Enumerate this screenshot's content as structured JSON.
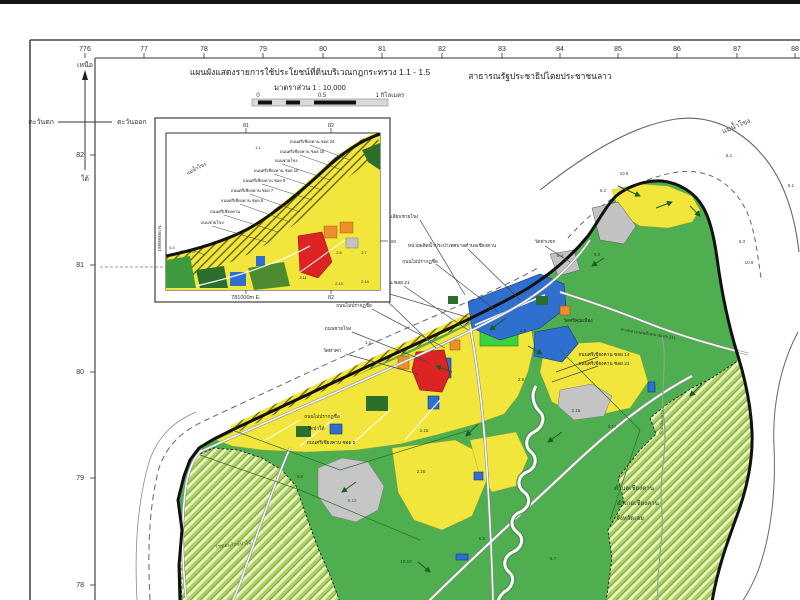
{
  "header": {
    "title": "แผนผังแสดงรายการใช้ประโยชน์ที่ดินบริเวณกฎกระทรวง 1.1 - 1.5",
    "scale_label": "มาตราส่วน 1 : 10,000",
    "scalebar": [
      "0",
      "0.5",
      "1 กิโลเมตร"
    ],
    "country": "สาธารณรัฐประชาธิปไตยประชาชนลาว"
  },
  "compass": {
    "north": "เหนือ",
    "south": "ใต้",
    "west": "ตะวันตก",
    "east": "ตะวันออก"
  },
  "grid": {
    "top": [
      {
        "t": "776",
        "x": 85
      },
      {
        "t": "77",
        "x": 144
      },
      {
        "t": "78",
        "x": 204
      },
      {
        "t": "79",
        "x": 263
      },
      {
        "t": "80",
        "x": 323
      },
      {
        "t": "81",
        "x": 382
      },
      {
        "t": "82",
        "x": 442
      },
      {
        "t": "83",
        "x": 502
      },
      {
        "t": "84",
        "x": 560
      },
      {
        "t": "85",
        "x": 618
      },
      {
        "t": "86",
        "x": 677
      },
      {
        "t": "87",
        "x": 737
      },
      {
        "t": "88",
        "x": 795
      }
    ],
    "left": [
      {
        "t": "82",
        "y": 155
      },
      {
        "t": "81",
        "y": 265
      },
      {
        "t": "80",
        "y": 372
      },
      {
        "t": "79",
        "y": 478
      },
      {
        "t": "78",
        "y": 585
      }
    ]
  },
  "inset": {
    "top_ticks": [
      {
        "t": "81",
        "x": 246
      },
      {
        "t": "82",
        "x": 331
      }
    ],
    "bottom_ticks": [
      {
        "t": "781000m E.",
        "x": 246
      },
      {
        "t": "82",
        "x": 331
      }
    ],
    "left_label": "1980000m N.",
    "right_tick": "80",
    "labels": [
      {
        "t": "แม่น้ำโขง",
        "x": 197,
        "y": 170,
        "r": -28,
        "s": 5
      },
      {
        "t": "1.1",
        "x": 258,
        "y": 149,
        "s": 4
      },
      {
        "t": "ถนนศรีเชียงคาน ซอย 24",
        "x": 312,
        "y": 143
      },
      {
        "t": "ถนนศรีเชียงคาน ซอย 18",
        "x": 302,
        "y": 153
      },
      {
        "t": "ถนนชายโขง",
        "x": 286,
        "y": 162
      },
      {
        "t": "ถนนศรีเชียงคาน ซอย 10",
        "x": 276,
        "y": 172
      },
      {
        "t": "ถนนศรีเชียงคาน ซอย 9",
        "x": 264,
        "y": 182
      },
      {
        "t": "ถนนศรีเชียงคาน ซอย 7",
        "x": 252,
        "y": 192
      },
      {
        "t": "ถนนศรีเชียงคาน ซอย 6",
        "x": 242,
        "y": 202
      },
      {
        "t": "ถนนศรีเชียงคาน",
        "x": 225,
        "y": 213
      },
      {
        "t": "ถนนชายโขง",
        "x": 212,
        "y": 224
      },
      {
        "t": "6.3",
        "x": 172,
        "y": 249,
        "s": 3.8
      },
      {
        "t": "วัดท่าคก",
        "x": 188,
        "y": 253,
        "s": 3.8
      },
      {
        "t": "2.8",
        "x": 339,
        "y": 254,
        "s": 3.8
      },
      {
        "t": "2.7",
        "x": 364,
        "y": 254,
        "s": 3.8
      },
      {
        "t": "2.11",
        "x": 303,
        "y": 279,
        "s": 3.8
      },
      {
        "t": "2.13",
        "x": 339,
        "y": 285,
        "s": 3.8
      },
      {
        "t": "2.14",
        "x": 365,
        "y": 283,
        "s": 3.8
      }
    ]
  },
  "map": {
    "labels": [
      {
        "t": "แม่น้ำโขง",
        "x": 737,
        "y": 128,
        "r": -22,
        "s": 7,
        "c": "#444"
      },
      {
        "t": "ถนนเลียบชายโขง",
        "x": 400,
        "y": 218,
        "s": 4.8
      },
      {
        "t": "หน่วยผลิตน้ำประปาเทศบาลตำบลเชียงคาน",
        "x": 452,
        "y": 247,
        "s": 4.8
      },
      {
        "t": "ถนนไม่ปรากฏชื่อ",
        "x": 420,
        "y": 263,
        "s": 4.8
      },
      {
        "t": "ถนนศรีเชียงคาน ซอย 21",
        "x": 384,
        "y": 284,
        "s": 4.8
      },
      {
        "t": "ถนนไม่ปรากฏชื่อ",
        "x": 354,
        "y": 307,
        "s": 4.8
      },
      {
        "t": "ถนนชายโขง",
        "x": 338,
        "y": 330,
        "s": 4.8
      },
      {
        "t": "วัดท่าคก",
        "x": 332,
        "y": 352,
        "s": 4.8
      },
      {
        "t": "1.1",
        "x": 368,
        "y": 344,
        "s": 4.5,
        "c": "#184f18"
      },
      {
        "t": "วัดท่าแขก",
        "x": 545,
        "y": 243,
        "s": 4.8
      },
      {
        "t": "6.4",
        "x": 560,
        "y": 257,
        "s": 4.5,
        "c": "#184f18"
      },
      {
        "t": "6.2",
        "x": 603,
        "y": 192,
        "s": 4.5,
        "c": "#184f18"
      },
      {
        "t": "10.8",
        "x": 624,
        "y": 175,
        "s": 4.5,
        "c": "#184f18"
      },
      {
        "t": "6.1",
        "x": 729,
        "y": 157,
        "s": 4.5,
        "c": "#184f18"
      },
      {
        "t": "6.1",
        "x": 791,
        "y": 187,
        "s": 4.5,
        "c": "#184f18"
      },
      {
        "t": "6.3",
        "x": 597,
        "y": 256,
        "s": 4.5,
        "c": "#184f18"
      },
      {
        "t": "6.3",
        "x": 742,
        "y": 243,
        "s": 4.5,
        "c": "#184f18"
      },
      {
        "t": "10.8",
        "x": 749,
        "y": 264,
        "s": 4.5,
        "c": "#184f18"
      },
      {
        "t": "2.8",
        "x": 523,
        "y": 332,
        "s": 4.5,
        "c": "#184f18"
      },
      {
        "t": "2.9",
        "x": 521,
        "y": 381,
        "s": 4.5,
        "c": "#184f18"
      },
      {
        "t": "2.15",
        "x": 576,
        "y": 412,
        "s": 4.5,
        "c": "#184f18"
      },
      {
        "t": "2.17",
        "x": 612,
        "y": 428,
        "s": 4.5,
        "c": "#184f18"
      },
      {
        "t": "2.16",
        "x": 424,
        "y": 432,
        "s": 4.5,
        "c": "#184f18"
      },
      {
        "t": "2.20",
        "x": 421,
        "y": 473,
        "s": 4.5,
        "c": "#184f18"
      },
      {
        "t": "9.13",
        "x": 352,
        "y": 502,
        "s": 4.5,
        "c": "#555"
      },
      {
        "t": "5.8",
        "x": 300,
        "y": 478,
        "s": 4.5,
        "c": "#184f18"
      },
      {
        "t": "5.7",
        "x": 553,
        "y": 560,
        "s": 4.5,
        "c": "#184f18"
      },
      {
        "t": "10.10",
        "x": 406,
        "y": 563,
        "s": 4.5,
        "c": "#184f18"
      },
      {
        "t": "6.5",
        "x": 482,
        "y": 540,
        "s": 4.5,
        "c": "#184f18"
      },
      {
        "t": "ตำบลเชียงคาน",
        "x": 634,
        "y": 490,
        "s": 6.2,
        "c": "#1c441c"
      },
      {
        "t": "อำเภอเชียงคาน",
        "x": 638,
        "y": 505,
        "s": 6.2,
        "c": "#1c441c"
      },
      {
        "t": "จังหวัดเลย",
        "x": 630,
        "y": 520,
        "s": 6.2,
        "c": "#1c441c"
      },
      {
        "t": "ถนนศรีเชียงคาน ซอย 14",
        "x": 604,
        "y": 356,
        "s": 4.8
      },
      {
        "t": "ถนนศรีเชียงคาน ซอย 21",
        "x": 604,
        "y": 365,
        "s": 4.8
      },
      {
        "t": "วัดศรีคุณเมือง",
        "x": 578,
        "y": 322,
        "s": 4.8
      },
      {
        "t": "เขตอนุรักษ์ป่าไม้",
        "x": 234,
        "y": 546,
        "r": -6,
        "s": 5,
        "c": "#2f5d16"
      },
      {
        "t": "ทางหลวงแผ่นดินหมายเลข 211",
        "x": 648,
        "y": 335,
        "r": 9,
        "s": 4.2,
        "c": "#333"
      },
      {
        "t": "ห้วยเชียงคาน",
        "x": 663,
        "y": 422,
        "r": -88,
        "s": 4.2,
        "c": "#2f5d16"
      },
      {
        "t": "ถนนไม่ปรากฏชื่อ",
        "x": 322,
        "y": 418,
        "s": 4.8
      },
      {
        "t": "วัดป่าใต้",
        "x": 316,
        "y": 430,
        "s": 4.8
      },
      {
        "t": "ถนนศรีเชียงคาน ซอย 5",
        "x": 331,
        "y": 444,
        "s": 4.8
      }
    ]
  },
  "colors": {
    "land_green": "#4fae4f",
    "residential_yellow": "#f2e63c",
    "commercial_red": "#dd2424",
    "commercial_orange": "#ef8e2a",
    "institution_blue": "#2e6fcf",
    "park_green": "#3fd23f",
    "gray_zone": "#c2c2c2",
    "dark_green_zone": "#2c6e2c",
    "rural_hatch": "#aed162",
    "shoreline_black": "#111111",
    "river_white": "#ffffff"
  }
}
